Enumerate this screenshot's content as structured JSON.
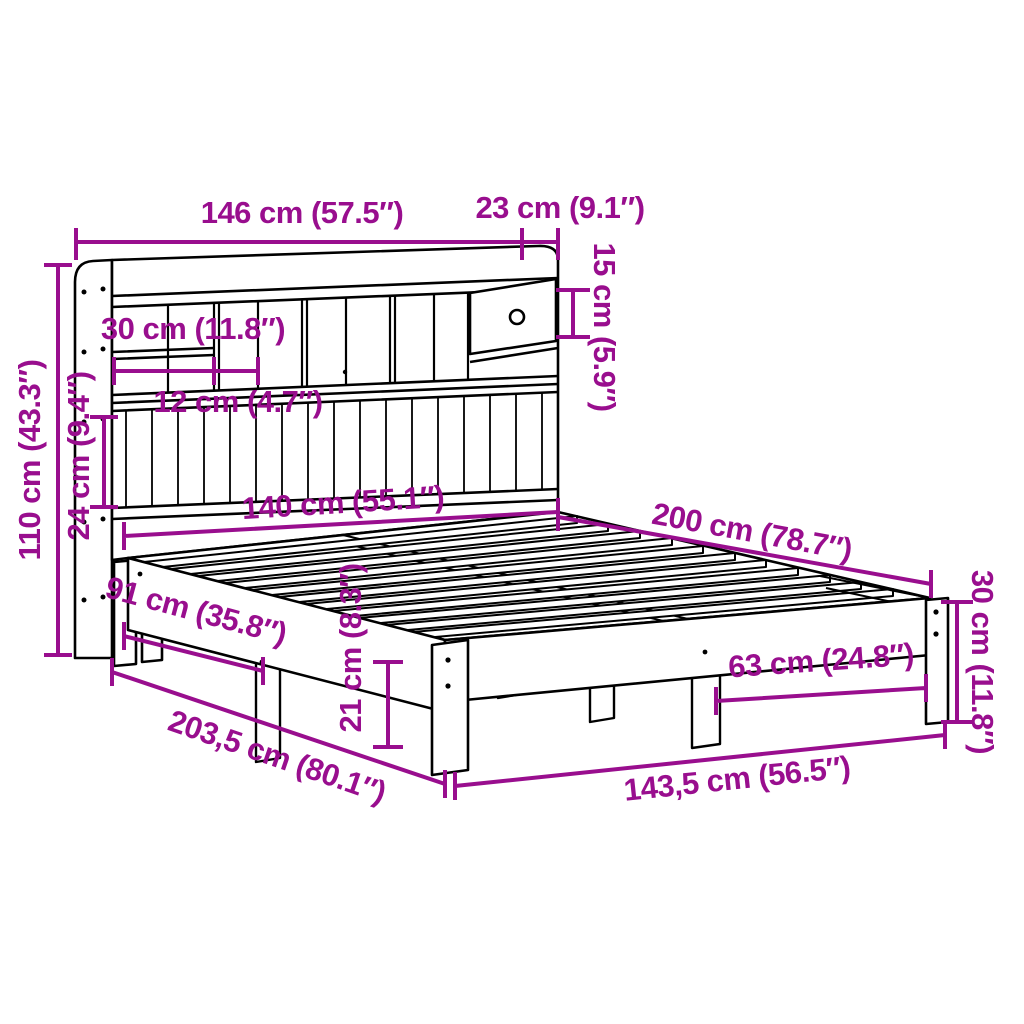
{
  "title": "Bookcase bed with drawer — dimension diagram",
  "colors": {
    "dimension_annotation": "#990E8E",
    "line_art": "#000000",
    "background": "#FFFFFF"
  },
  "labels": {
    "headboard_width": "146 cm (57.5″)",
    "headboard_depth": "23 cm (9.1″)",
    "drawer_height": "15 cm (5.9″)",
    "compartment_width": "30 cm (11.8″)",
    "slot_width": "12 cm (4.7″)",
    "headboard_height": "110 cm (43.3″)",
    "slat_panel_height": "24 cm (9.4″)",
    "mattress_width": "140 cm (55.1″)",
    "bed_length": "200 cm (78.7″)",
    "frame_height": "30 cm (11.8″)",
    "foot_leg_spacing": "63 cm (24.8″)",
    "under_bed_clearance": "21 cm (8.3″)",
    "total_length": "203,5 cm (80.1″)",
    "side_leg_offset": "91 cm (35.8″)",
    "frame_width": "143,5 cm (56.5″)"
  }
}
